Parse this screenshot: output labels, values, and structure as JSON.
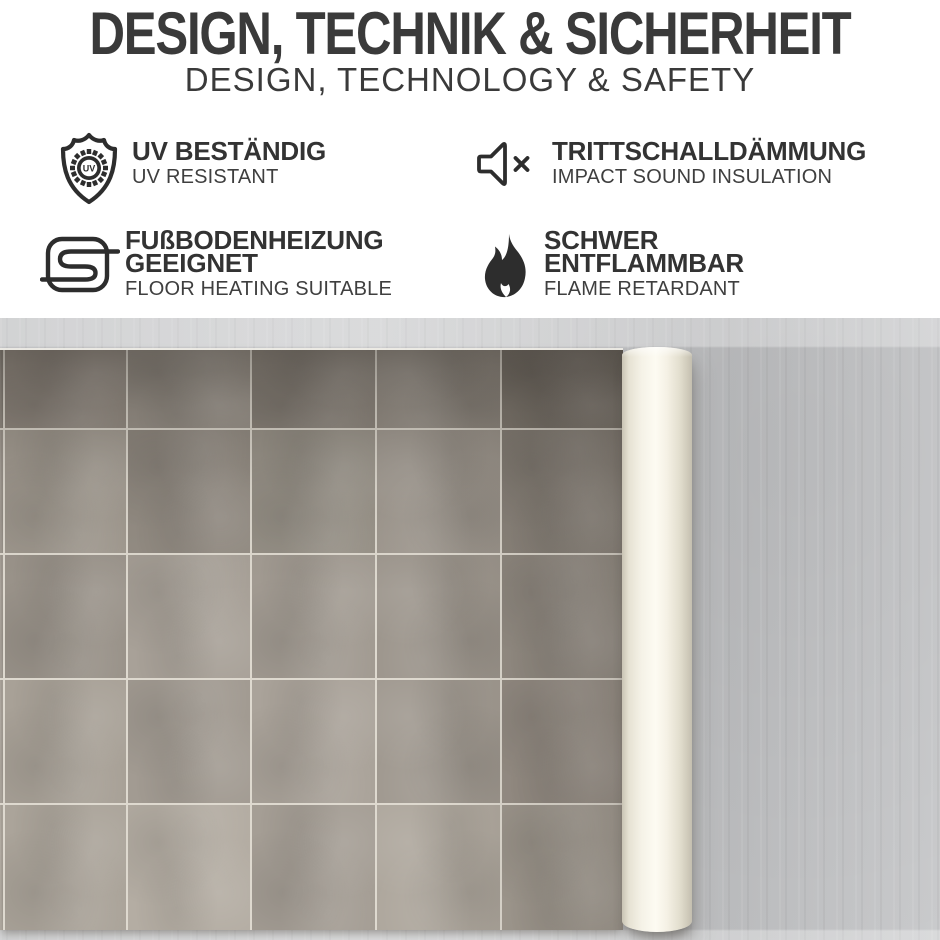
{
  "header": {
    "title": "DESIGN, TECHNIK & SICHERHEIT",
    "subtitle": "DESIGN, TECHNOLOGY & SAFETY"
  },
  "features": [
    {
      "icon": "uv-shield-icon",
      "title": "UV BESTÄNDIG",
      "subtitle": "UV RESISTANT"
    },
    {
      "icon": "speaker-muted-icon",
      "title": "TRITTSCHALLDÄMMUNG",
      "subtitle": "IMPACT SOUND INSULATION"
    },
    {
      "icon": "floor-heating-icon",
      "title": "FUßBODENHEIZUNG\nGEEIGNET",
      "subtitle": "FLOOR HEATING SUITABLE"
    },
    {
      "icon": "flame-icon",
      "title": "SCHWER\nENTFLAMMBAR",
      "subtitle": "FLAME RETARDANT"
    }
  ],
  "uv_badge_label": "UV",
  "colors": {
    "heading_text": "#3a3a3a",
    "feature_text": "#333333",
    "icon_stroke": "#2d2d2d",
    "concrete": "#c5c6c8",
    "grout": "#ded9cf",
    "roll": "#fdfbf2"
  },
  "photo": {
    "tile_colors": [
      [
        "#8d867d",
        "#948c83",
        "#9a938a",
        "#8e877e",
        "#968f86",
        "#837c73"
      ],
      [
        "#9d968d",
        "#a29b91",
        "#948d84",
        "#9a948a",
        "#a09990",
        "#8d867d"
      ],
      [
        "#a09990",
        "#9a938a",
        "#a8a198",
        "#a29b92",
        "#9d968d",
        "#948d84"
      ],
      [
        "#a59e95",
        "#a8a197",
        "#a29b92",
        "#aaa39a",
        "#a09990",
        "#978f86"
      ],
      [
        "#a9a298",
        "#aba49a",
        "#b4ada3",
        "#a59e95",
        "#aea79d",
        "#a29b91"
      ]
    ]
  }
}
